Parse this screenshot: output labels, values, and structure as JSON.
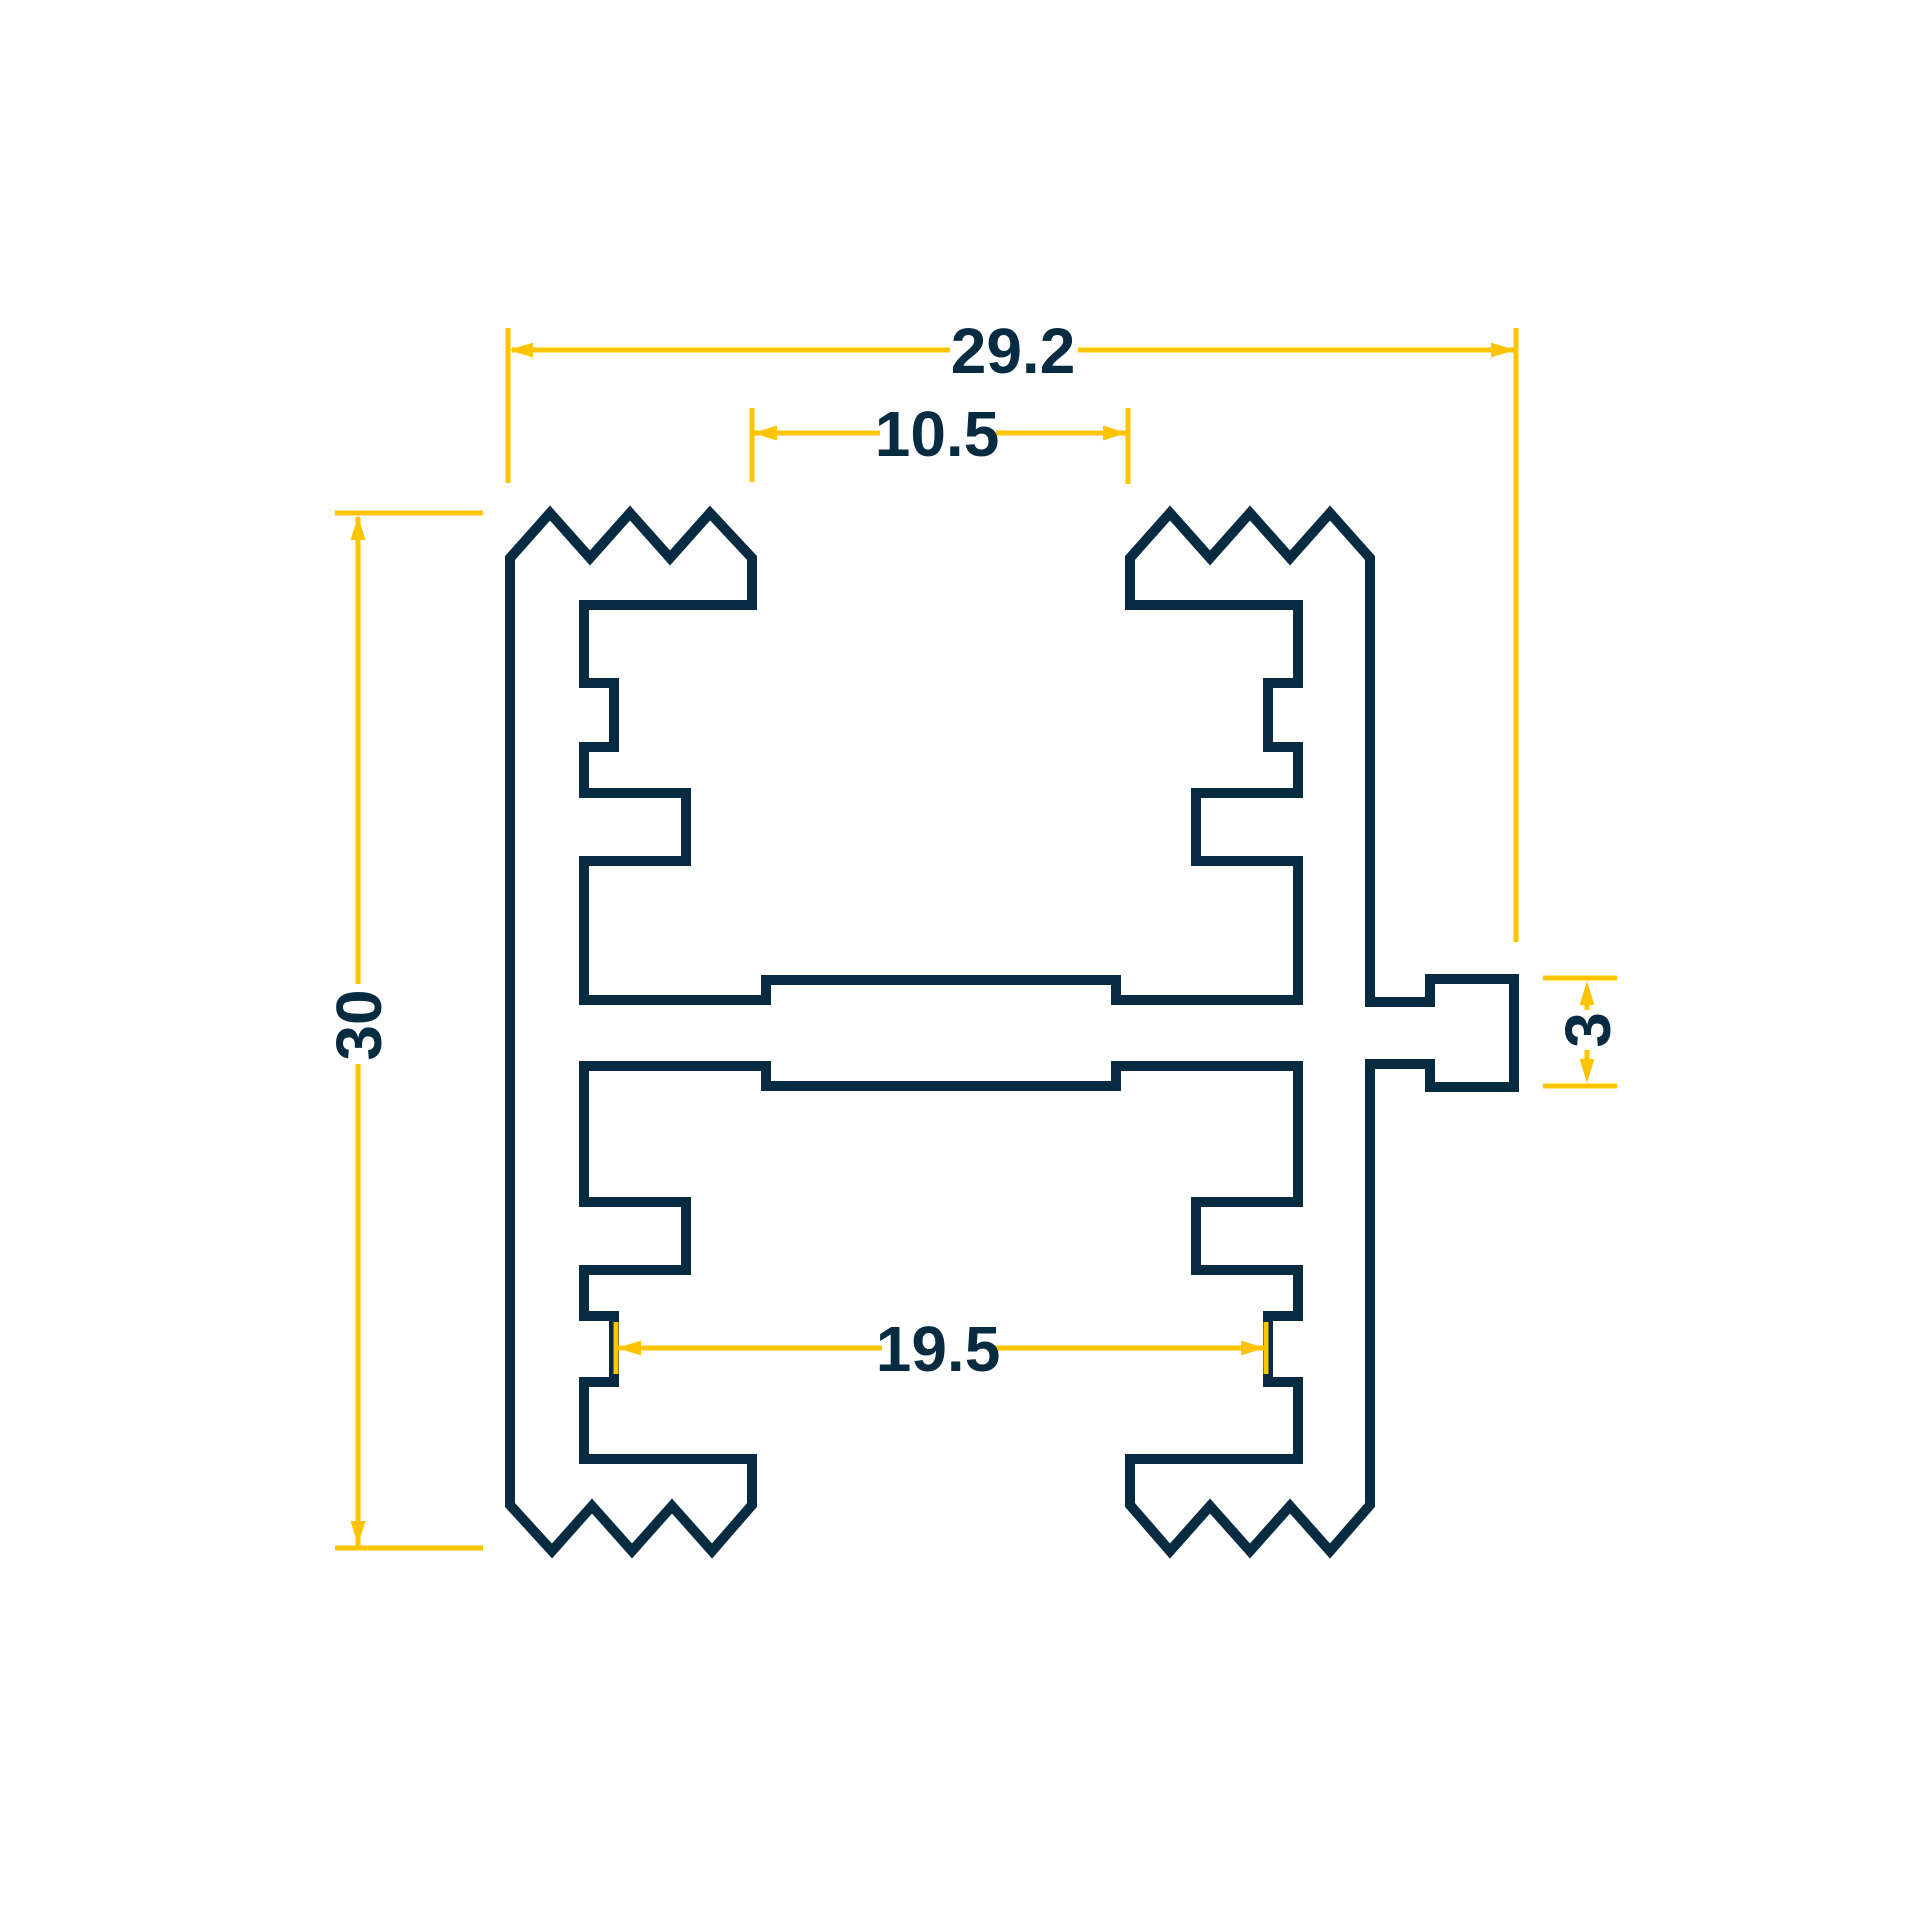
{
  "drawing": {
    "colors": {
      "profile_line": "#072c42",
      "dimension_line": "#ffc400",
      "background": "#ffffff"
    },
    "dimensions": {
      "total_width": "29.2",
      "top_opening_width": "10.5",
      "total_height": "30",
      "side_tab_height": "3",
      "inner_slot_width": "19.5"
    }
  }
}
